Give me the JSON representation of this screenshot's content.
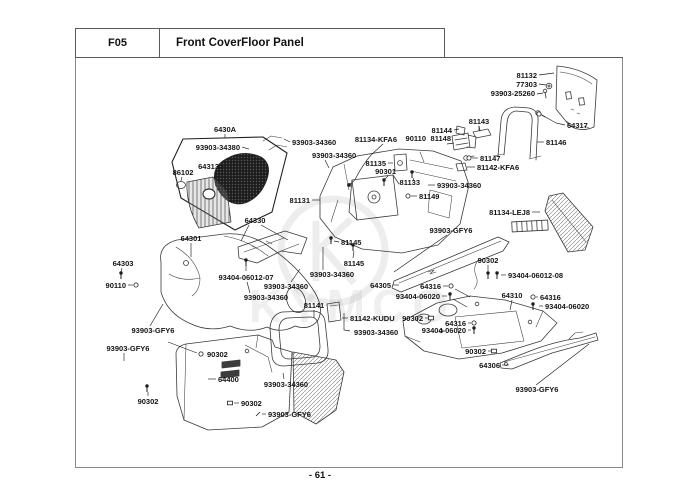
{
  "header": {
    "code": "F05",
    "title": "Front CoverFloor Panel"
  },
  "footer": {
    "page_number": "- 61 -"
  },
  "watermark": {
    "text": "KYMCO"
  },
  "diagram": {
    "labels": [
      {
        "t": "81132",
        "a": "e",
        "x": 537,
        "y": 78,
        "L": [
          [
            [
              539,
              75
            ],
            [
              554,
              73
            ]
          ]
        ]
      },
      {
        "t": "77303",
        "a": "e",
        "x": 537,
        "y": 87,
        "L": [
          [
            [
              539,
              84
            ],
            [
              546,
              85
            ]
          ]
        ]
      },
      {
        "t": "93903-25260",
        "a": "e",
        "x": 535,
        "y": 96,
        "L": [
          [
            [
              537,
              94
            ],
            [
              543,
              93
            ]
          ]
        ]
      },
      {
        "t": "64317",
        "a": "s",
        "x": 567,
        "y": 128,
        "L": [
          [
            [
              565,
              125
            ],
            [
              556,
              123
            ],
            [
              542,
              115
            ]
          ]
        ],
        "m": "nut",
        "mp": [
          539,
          114
        ]
      },
      {
        "t": "81143",
        "a": "m",
        "x": 479,
        "y": 124,
        "L": [
          [
            [
              479,
              126
            ],
            [
              479,
              131
            ]
          ]
        ]
      },
      {
        "t": "81144",
        "a": "e",
        "x": 452,
        "y": 133,
        "L": [
          [
            [
              454,
              130
            ],
            [
              459,
              129
            ]
          ]
        ]
      },
      {
        "t": "90110",
        "a": "e",
        "x": 426,
        "y": 141
      },
      {
        "t": "81148",
        "a": "e",
        "x": 451,
        "y": 141,
        "L": [
          [
            [
              447,
              144
            ],
            [
              454,
              143
            ]
          ]
        ]
      },
      {
        "t": "81146",
        "a": "s",
        "x": 546,
        "y": 145,
        "L": [
          [
            [
              544,
              142
            ],
            [
              537,
              142
            ]
          ]
        ]
      },
      {
        "t": "81147",
        "a": "s",
        "x": 480,
        "y": 161,
        "L": [
          [
            [
              478,
              158
            ],
            [
              472,
              158
            ]
          ]
        ],
        "m": "nut",
        "mp": [
          469,
          158
        ]
      },
      {
        "t": "81142-KFA6",
        "a": "s",
        "x": 477,
        "y": 170,
        "L": [
          [
            [
              475,
              167
            ],
            [
              467,
              167
            ]
          ]
        ]
      },
      {
        "t": "81134-KFA6",
        "a": "e",
        "x": 397,
        "y": 142,
        "L": [
          [
            [
              383,
              144
            ],
            [
              371,
              155
            ]
          ]
        ]
      },
      {
        "t": "81135",
        "a": "e",
        "x": 386,
        "y": 166,
        "L": [
          [
            [
              388,
              163
            ],
            [
              393,
              163
            ]
          ]
        ]
      },
      {
        "t": "90301",
        "a": "e",
        "x": 396,
        "y": 174,
        "L": [
          [
            [
              388,
              176
            ],
            [
              385,
              179
            ]
          ]
        ],
        "m": "screw",
        "mp": [
          384,
          182
        ]
      },
      {
        "t": "81133",
        "a": "e",
        "x": 420,
        "y": 185,
        "L": [
          [
            [
              414,
              181
            ],
            [
              413,
              178
            ]
          ]
        ],
        "m": "screw",
        "mp": [
          412,
          174
        ]
      },
      {
        "t": "93903-34360",
        "a": "s",
        "x": 437,
        "y": 188,
        "L": [
          [
            [
              435,
              185
            ],
            [
              428,
              185
            ]
          ]
        ]
      },
      {
        "t": "81149",
        "a": "s",
        "x": 419,
        "y": 199,
        "L": [
          [
            [
              417,
              196
            ],
            [
              411,
              196
            ]
          ]
        ],
        "m": "nut",
        "mp": [
          408,
          196
        ]
      },
      {
        "t": "81134-LEJ8",
        "a": "e",
        "x": 530,
        "y": 215,
        "L": [
          [
            [
              532,
              212
            ],
            [
              540,
              212
            ]
          ]
        ]
      },
      {
        "t": "6430A",
        "a": "m",
        "x": 225,
        "y": 132,
        "L": [
          [
            [
              225,
              134
            ],
            [
              225,
              138
            ]
          ]
        ]
      },
      {
        "t": "93903-34380",
        "a": "e",
        "x": 240,
        "y": 150,
        "L": [
          [
            [
              242,
              147
            ],
            [
              249,
              149
            ]
          ]
        ]
      },
      {
        "t": "64313",
        "a": "e",
        "x": 219,
        "y": 169,
        "L": [
          [
            [
              221,
              166
            ],
            [
              228,
              168
            ]
          ]
        ]
      },
      {
        "t": "86102",
        "a": "m",
        "x": 183,
        "y": 175,
        "L": [
          [
            [
              182,
              177
            ],
            [
              181,
              181
            ]
          ]
        ]
      },
      {
        "t": "93903-34360",
        "a": "s",
        "x": 292,
        "y": 145,
        "L": [
          [
            [
              290,
              142
            ],
            [
              284,
              139
            ]
          ]
        ]
      },
      {
        "t": "93903-34360",
        "a": "s",
        "x": 312,
        "y": 158,
        "L": [
          [
            [
              325,
              160
            ],
            [
              329,
              168
            ]
          ]
        ]
      },
      {
        "t": "81131",
        "a": "e",
        "x": 310,
        "y": 203,
        "L": [
          [
            [
              312,
              200
            ],
            [
              320,
              200
            ]
          ]
        ]
      },
      {
        "t": "64330",
        "a": "m",
        "x": 255,
        "y": 223,
        "L": [
          [
            [
              249,
              225
            ],
            [
              241,
              241
            ]
          ],
          [
            [
              261,
              225
            ],
            [
              288,
              240
            ]
          ]
        ]
      },
      {
        "t": "64301",
        "a": "m",
        "x": 191,
        "y": 241,
        "L": [
          [
            [
              191,
              243
            ],
            [
              191,
              257
            ]
          ]
        ]
      },
      {
        "t": "64303",
        "a": "m",
        "x": 123,
        "y": 266,
        "L": [
          [
            [
              122,
              268
            ],
            [
              121,
              272
            ]
          ]
        ],
        "m": "screw",
        "mp": [
          121,
          275
        ]
      },
      {
        "t": "90110",
        "a": "e",
        "x": 126,
        "y": 288,
        "L": [
          [
            [
              128,
              285
            ],
            [
              133,
              285
            ]
          ]
        ],
        "m": "nut",
        "mp": [
          136,
          285
        ]
      },
      {
        "t": "93404-06012-07",
        "a": "m",
        "x": 246,
        "y": 280,
        "L": [
          [
            [
              246,
              271
            ],
            [
              246,
              266
            ]
          ]
        ],
        "m": "screw",
        "mp": [
          246,
          262
        ]
      },
      {
        "t": "81145",
        "a": "s",
        "x": 341,
        "y": 245,
        "L": [
          [
            [
              339,
              242
            ],
            [
              334,
              241
            ]
          ]
        ],
        "m": "screw",
        "mp": [
          331,
          240
        ]
      },
      {
        "t": "81145",
        "a": "m",
        "x": 354,
        "y": 266,
        "L": [
          [
            [
              353,
              258
            ],
            [
              354,
              251
            ]
          ]
        ],
        "m": "screw",
        "mp": [
          353,
          247
        ]
      },
      {
        "t": "93903-34360",
        "a": "m",
        "x": 332,
        "y": 277,
        "L": [
          [
            [
              323,
              270
            ],
            [
              323,
              247
            ]
          ]
        ]
      },
      {
        "t": "93903-34360",
        "a": "m",
        "x": 286,
        "y": 289,
        "L": [
          [
            [
              291,
              282
            ],
            [
              300,
              269
            ]
          ]
        ]
      },
      {
        "t": "93903-34360",
        "a": "m",
        "x": 266,
        "y": 300,
        "L": [
          [
            [
              250,
              293
            ],
            [
              247,
              282
            ]
          ]
        ]
      },
      {
        "t": "64305",
        "a": "e",
        "x": 391,
        "y": 288,
        "L": [
          [
            [
              393,
              285
            ],
            [
              399,
              285
            ]
          ]
        ]
      },
      {
        "t": "93903-GFY6",
        "a": "m",
        "x": 451,
        "y": 233,
        "L": [
          [
            [
              447,
              235
            ],
            [
              394,
              272
            ]
          ]
        ]
      },
      {
        "t": "90302",
        "a": "m",
        "x": 488,
        "y": 263,
        "L": [
          [
            [
              488,
              265
            ],
            [
              488,
              271
            ]
          ]
        ],
        "m": "screw",
        "mp": [
          488,
          275
        ]
      },
      {
        "t": "93404-06012-08",
        "a": "s",
        "x": 508,
        "y": 278,
        "L": [
          [
            [
              506,
              275
            ],
            [
              501,
              275
            ]
          ]
        ],
        "m": "screw",
        "mp": [
          497,
          275
        ]
      },
      {
        "t": "64316",
        "a": "e",
        "x": 441,
        "y": 289,
        "L": [
          [
            [
              443,
              286
            ],
            [
              448,
              286
            ]
          ],
          [
            [
              455,
              289
            ],
            [
              470,
              297
            ]
          ]
        ],
        "m": "nut",
        "mp": [
          451,
          286
        ]
      },
      {
        "t": "93404-06020",
        "a": "e",
        "x": 440,
        "y": 299,
        "L": [
          [
            [
              442,
              296
            ],
            [
              447,
              296
            ]
          ],
          [
            [
              453,
              299
            ],
            [
              467,
              307
            ]
          ]
        ],
        "m": "screw",
        "mp": [
          450,
          296
        ]
      },
      {
        "t": "64310",
        "a": "m",
        "x": 512,
        "y": 298,
        "L": [
          [
            [
              512,
              300
            ],
            [
              510,
              310
            ]
          ]
        ]
      },
      {
        "t": "64316",
        "a": "s",
        "x": 540,
        "y": 300,
        "L": [
          [
            [
              538,
              297
            ],
            [
              536,
              297
            ]
          ]
        ],
        "m": "nut",
        "mp": [
          533,
          297
        ]
      },
      {
        "t": "93404-06020",
        "a": "s",
        "x": 545,
        "y": 309,
        "L": [
          [
            [
              543,
              306
            ],
            [
              539,
              306
            ]
          ]
        ],
        "m": "screw",
        "mp": [
          533,
          306
        ]
      },
      {
        "t": "90302",
        "a": "e",
        "x": 423,
        "y": 321,
        "L": [
          [
            [
              425,
              318
            ],
            [
              428,
              318
            ]
          ]
        ],
        "m": "clip",
        "mp": [
          431,
          318
        ]
      },
      {
        "t": "64316",
        "a": "e",
        "x": 466,
        "y": 326,
        "L": [
          [
            [
              468,
              323
            ],
            [
              471,
              323
            ]
          ]
        ],
        "m": "nut",
        "mp": [
          474,
          323
        ]
      },
      {
        "t": "93404-06020",
        "a": "e",
        "x": 466,
        "y": 333,
        "L": [
          [
            [
              468,
              330
            ],
            [
              471,
              330
            ]
          ]
        ],
        "m": "screw",
        "mp": [
          474,
          330
        ]
      },
      {
        "t": "90302",
        "a": "e",
        "x": 486,
        "y": 354,
        "L": [
          [
            [
              488,
              351
            ],
            [
              491,
              351
            ]
          ]
        ],
        "m": "clip",
        "mp": [
          494,
          351
        ]
      },
      {
        "t": "64306",
        "a": "e",
        "x": 500,
        "y": 368,
        "L": [
          [
            [
              502,
              365
            ],
            [
              509,
              365
            ]
          ]
        ]
      },
      {
        "t": "93903-GFY6",
        "a": "m",
        "x": 537,
        "y": 392,
        "L": [
          [
            [
              536,
              385
            ],
            [
              589,
              344
            ]
          ]
        ]
      },
      {
        "t": "93903-GFY6",
        "a": "m",
        "x": 153,
        "y": 333,
        "L": [
          [
            [
              150,
              326
            ],
            [
              163,
              304
            ]
          ]
        ]
      },
      {
        "t": "93903-GFY6",
        "a": "m",
        "x": 128,
        "y": 351,
        "L": [
          [
            [
              124,
              353
            ],
            [
              124,
              361
            ]
          ]
        ]
      },
      {
        "t": "90302",
        "a": "s",
        "x": 207,
        "y": 357,
        "L": [
          [
            [
              197,
              353
            ],
            [
              168,
              342
            ]
          ]
        ],
        "m": "nut",
        "mp": [
          201,
          354
        ]
      },
      {
        "t": "90302",
        "a": "m",
        "x": 148,
        "y": 404,
        "L": [
          [
            [
              148,
              396
            ],
            [
              148,
              392
            ]
          ]
        ],
        "m": "screw",
        "mp": [
          147,
          388
        ]
      },
      {
        "t": "64400",
        "a": "s",
        "x": 218,
        "y": 382,
        "L": [
          [
            [
              216,
              379
            ],
            [
              208,
              379
            ]
          ]
        ]
      },
      {
        "t": "93903-34360",
        "a": "m",
        "x": 286,
        "y": 387,
        "L": [
          [
            [
              284,
              379
            ],
            [
              283,
              373
            ]
          ]
        ]
      },
      {
        "t": "90302",
        "a": "s",
        "x": 241,
        "y": 406,
        "L": [
          [
            [
              239,
              403
            ],
            [
              234,
              403
            ]
          ]
        ],
        "m": "clip",
        "mp": [
          230,
          403
        ]
      },
      {
        "t": "93903-GFY6",
        "a": "s",
        "x": 268,
        "y": 417,
        "L": [
          [
            [
              266,
              414
            ],
            [
              262,
              414
            ]
          ]
        ],
        "m": "tick",
        "mp": [
          258,
          414
        ]
      },
      {
        "t": "81141",
        "a": "m",
        "x": 314,
        "y": 308,
        "L": [
          [
            [
              314,
              310
            ],
            [
              314,
              318
            ]
          ]
        ]
      },
      {
        "t": "81142-KUDU",
        "a": "s",
        "x": 350,
        "y": 321,
        "L": [
          [
            [
              348,
              318
            ],
            [
              342,
              318
            ]
          ]
        ]
      },
      {
        "t": "93903-34360",
        "a": "s",
        "x": 354,
        "y": 335,
        "L": [
          [
            [
              350,
              331
            ],
            [
              344,
              330
            ],
            [
              344,
              313
            ]
          ]
        ]
      }
    ]
  }
}
